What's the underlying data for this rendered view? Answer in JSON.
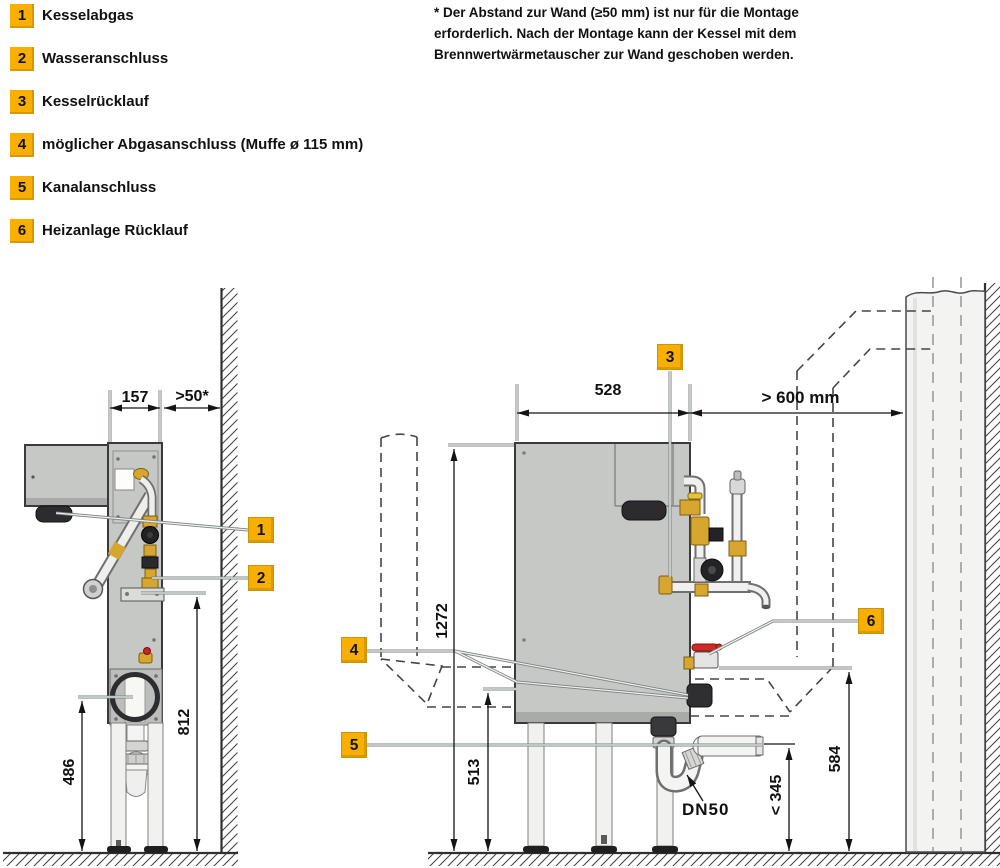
{
  "accent_color": "#F8AF00",
  "legend": {
    "items": [
      {
        "num": "1",
        "label": "Kesselabgas"
      },
      {
        "num": "2",
        "label": "Wasseranschluss"
      },
      {
        "num": "3",
        "label": "Kesselrücklauf"
      },
      {
        "num": "4",
        "label": "möglicher Abgasanschluss (Muffe ø 115 mm)"
      },
      {
        "num": "5",
        "label": "Kanalanschluss"
      },
      {
        "num": "6",
        "label": "Heizanlage Rücklauf"
      }
    ]
  },
  "note": {
    "lines": [
      "* Der Abstand zur Wand (≥50 mm) ist nur für die Montage",
      "erforderlich. Nach der Montage kann der Kessel mit dem",
      "Brennwertwärmetauscher zur Wand geschoben werden."
    ]
  },
  "dimensions": {
    "side_view": {
      "width": "157",
      "wall_gap": ">50*",
      "connection_height": "812",
      "drain_height": "486"
    },
    "front_view": {
      "width": "528",
      "wall_clearance": "> 600 mm",
      "total_height": "1272",
      "flue_height": "513",
      "return_height": "584",
      "drain_max_height": "< 345",
      "drain_pipe": "DN50"
    }
  }
}
